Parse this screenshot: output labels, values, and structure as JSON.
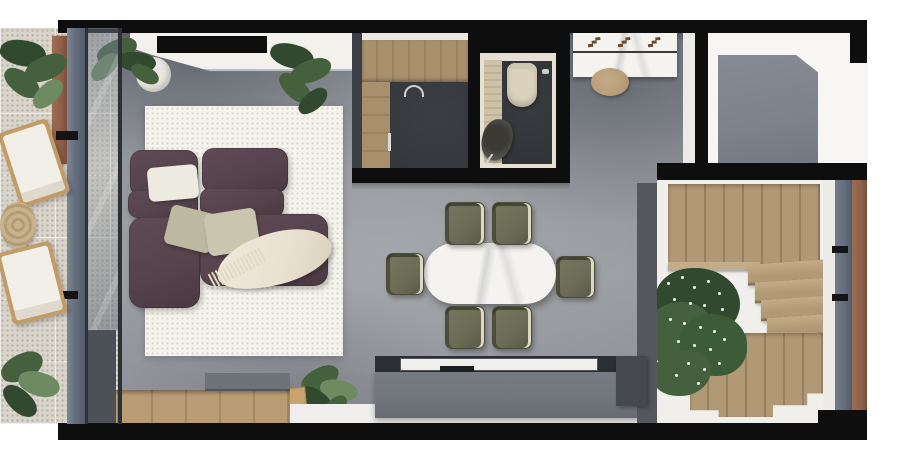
{
  "scene": {
    "type": "floor-plan-3d-render",
    "view": "top-down",
    "description": "Top-down render of a narrow apartment: left balcony, living/dining area, kitchen, bathroom, entry hall, porch and U-shaped wooden staircase"
  },
  "palette": {
    "wall": "#0e0e0e",
    "concrete": "#94979c",
    "concrete_dark": "#7e838b",
    "tile": "#d9d5cc",
    "tile_dot": "#b8b3a6",
    "rug": "#f5f3ed",
    "rug_dot": "#d9d6c9",
    "sofa": "#56434d",
    "sofa_deep": "#4a3942",
    "pillow_white": "#edebdf",
    "pillow_sage_a": "#bdb9a1",
    "pillow_sage_b": "#cac5ae",
    "throw_cream": "#e9e1d0",
    "chair_olive": "#6d6d57",
    "chair_olive_dark": "#585847",
    "chair_trim": "#dcd8c2",
    "wood": "#b29976",
    "wood_dark": "#97805f",
    "wood_light": "#c3ac88",
    "deck_wood": "#b89c74",
    "deck_wood_dark": "#a3895f",
    "marble": "#f4f3f0",
    "marble_line": "#3a3a3a",
    "travertine": "#cdc1a8",
    "bath_wall": "#e7e1d3",
    "bath_floor": "#2f3236",
    "kitchen_floor": "#34373c",
    "toilet_beige": "#dbd2bd",
    "console_top": "#2b2f34",
    "console_body": "#71767d",
    "tv_inset": "#f1f0ed",
    "white_ledge": "#efeeec",
    "frame_blue": "#646e7d",
    "frame_copper": "#8f614a",
    "glass_edge": "#2c3136",
    "track_dark": "#4c5157",
    "stool_wood": "#b59b77",
    "lounger_wood": "#c29c66",
    "plant_dark": "#31492e",
    "plant_mid": "#44603c",
    "plant_light": "#6d8a60",
    "flower_white": "#f4f6ee",
    "glyph_brown": "#6b4a2f",
    "step_gray": "#6e737a",
    "strip_dark": "#54585d",
    "charcoal_box": "#45494e"
  },
  "rooms": [
    {
      "id": "balcony",
      "furniture": [
        "lounge-chair",
        "lounge-chair",
        "woven-pouf",
        "potted-plants"
      ]
    },
    {
      "id": "living-room",
      "furniture": [
        "modular-sofa",
        "area-rug",
        "pillows",
        "throw-blanket",
        "wall-console",
        "potted-plants",
        "wood-deck"
      ]
    },
    {
      "id": "dining-area",
      "furniture": [
        "oval-marble-table",
        "dining-chair-x6",
        "tv-console"
      ]
    },
    {
      "id": "kitchen",
      "furniture": [
        "l-shaped-wood-counter",
        "faucet"
      ]
    },
    {
      "id": "bathroom",
      "furniture": [
        "toilet",
        "stone-sink",
        "travertine-counter"
      ]
    },
    {
      "id": "entry-hall",
      "furniture": [
        "marble-console",
        "wood-stool"
      ]
    },
    {
      "id": "porch",
      "furniture": []
    },
    {
      "id": "staircase",
      "furniture": [
        "upper-flight",
        "winder-treads",
        "lower-flight",
        "flowering-plant"
      ]
    }
  ],
  "counts": {
    "dining_chairs": 6,
    "lounge_chairs": 2,
    "stair_flights": 2,
    "winder_treads": 4
  }
}
